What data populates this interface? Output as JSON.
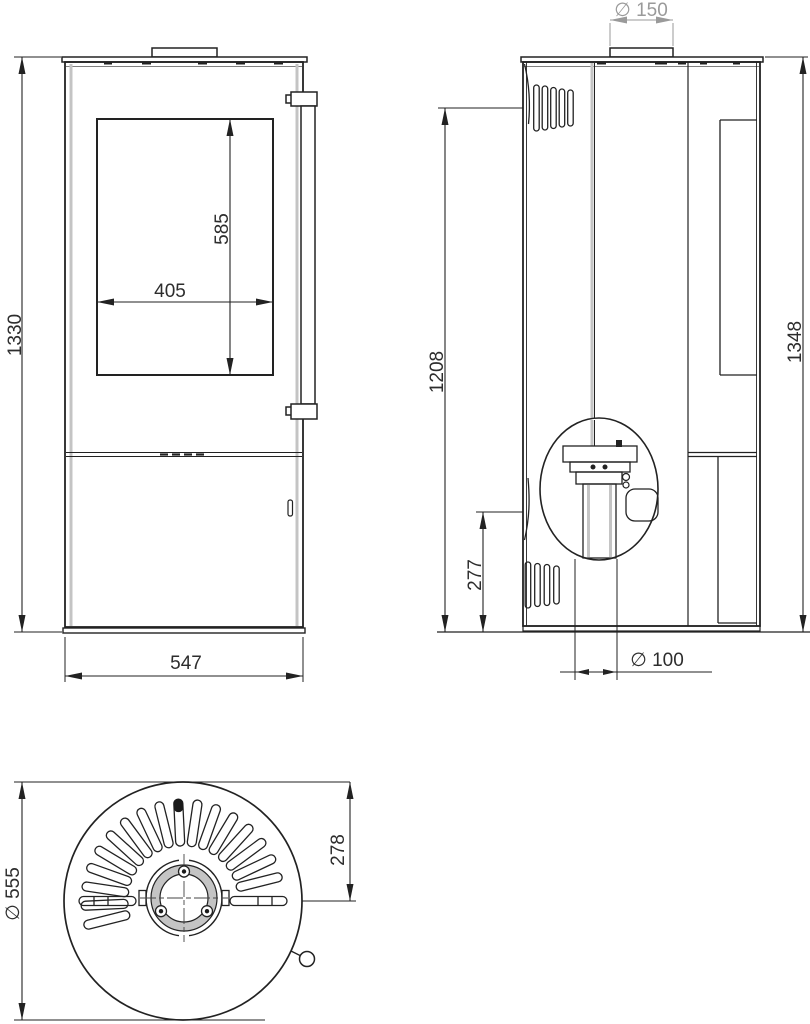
{
  "drawing": {
    "type": "stove-technical-dimension-drawing",
    "views": [
      "front-view",
      "side-view",
      "top-view"
    ]
  },
  "colors": {
    "line": "#222222",
    "dim_gray": "#9a9a9a",
    "panel_shade": "#c4c4c4"
  },
  "dimensions": {
    "front_overall_height": "1330",
    "front_overall_width": "547",
    "glass_height": "585",
    "glass_width": "405",
    "flue_diameter": "∅ 150",
    "side_left_height": "1208",
    "side_overall_height": "1348",
    "rear_connection_height": "277",
    "rear_connection_diameter": "∅ 100",
    "top_view_diameter": "∅ 555",
    "flue_center_from_front": "278"
  }
}
